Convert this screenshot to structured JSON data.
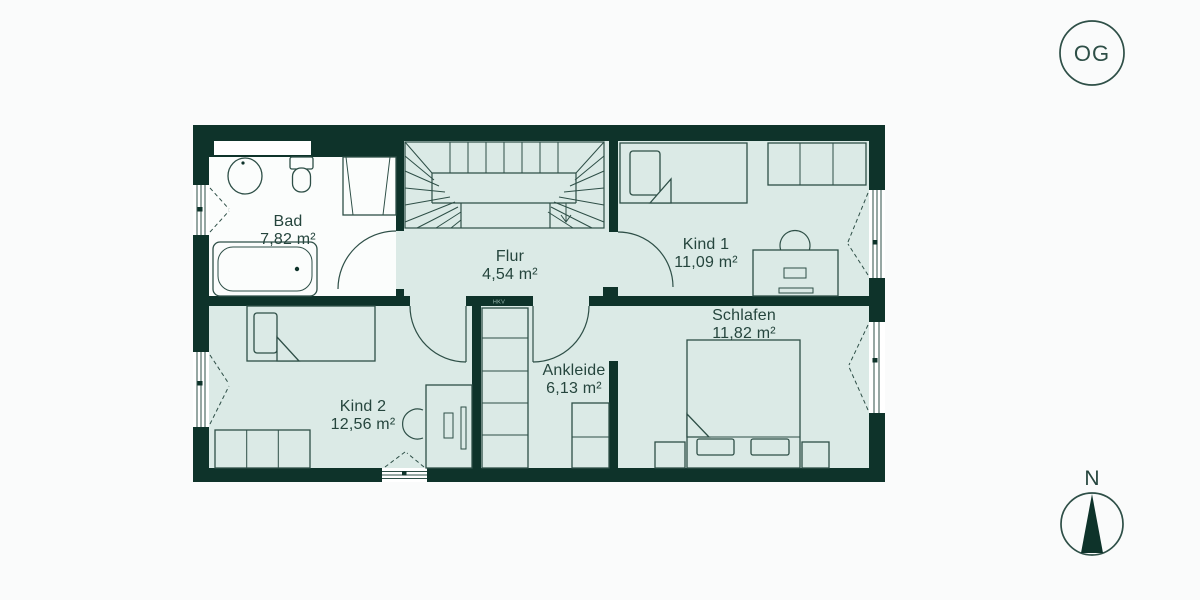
{
  "palette": {
    "wall": "#0e332a",
    "room": "#dbeae6",
    "whiteroom": "#fbfdfc",
    "line": "#2e4f47",
    "text": "#25453d",
    "bg": "#fafbfb",
    "hkv": "#9dbcb3"
  },
  "floor_badge": {
    "label": "OG"
  },
  "compass": {
    "label": "N"
  },
  "rooms": [
    {
      "id": "bad",
      "name": "Bad",
      "area": "7,82 m²"
    },
    {
      "id": "flur",
      "name": "Flur",
      "area": "4,54 m²"
    },
    {
      "id": "kind1",
      "name": "Kind 1",
      "area": "11,09 m²"
    },
    {
      "id": "kind2",
      "name": "Kind 2",
      "area": "12,56 m²"
    },
    {
      "id": "ankleide",
      "name": "Ankleide",
      "area": "6,13 m²"
    },
    {
      "id": "schlafen",
      "name": "Schlafen",
      "area": "11,82 m²"
    }
  ],
  "annotations": {
    "hkv": "HKV"
  }
}
